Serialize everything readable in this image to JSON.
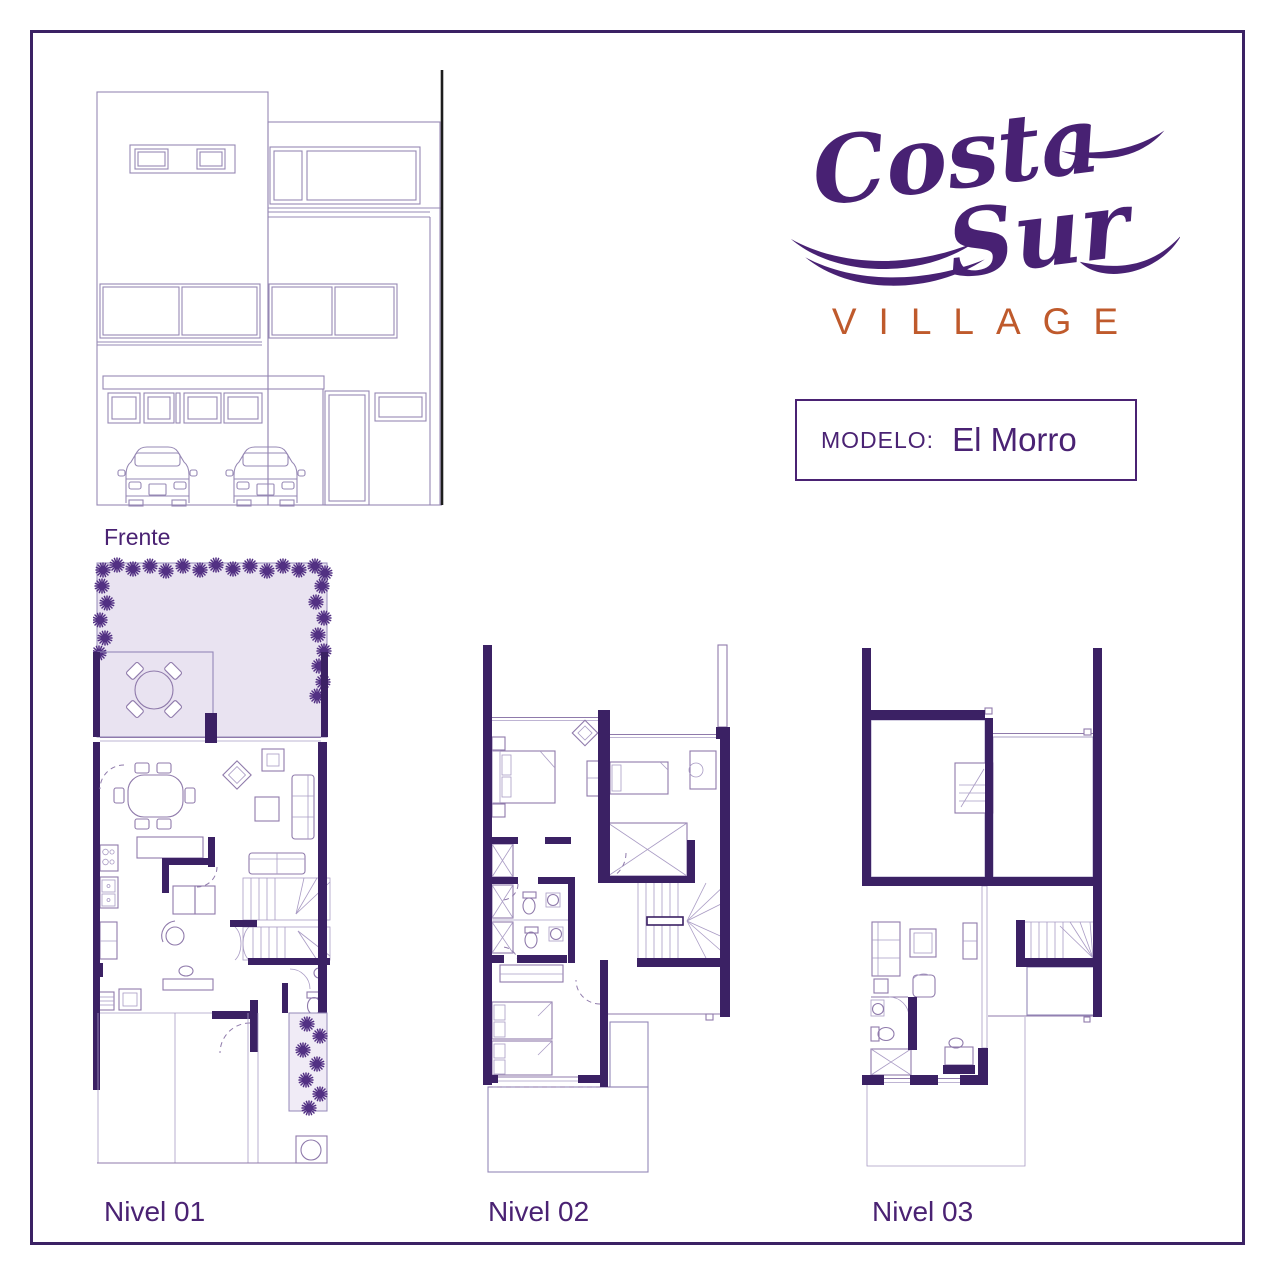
{
  "brand": {
    "name_part1": "Costa",
    "name_part2": "Sur",
    "subtitle": "VILLAGE"
  },
  "model": {
    "label": "MODELO:",
    "value": "El Morro"
  },
  "captions": {
    "elevation": "Frente",
    "level1": "Nivel 01",
    "level2": "Nivel 02",
    "level3": "Nivel 03"
  },
  "drawings": {
    "elevation": "three-story townhouse front elevation with carport, two cars, window bands and entry door",
    "level1": "ground floor plan: front garden with shrubs, wood deck with round table, living-dining room, kitchen, study, stairs, powder room, two-car garage with side planter",
    "level2": "second floor plan: master bedroom, two secondary bedrooms, two bathrooms, closets, stairs and large striped terrace",
    "level3": "third floor plan: two tiled roof terraces, family room, bathroom, desk nook, stairs and lower roof terrace"
  },
  "colors": {
    "wall": "#3b2164",
    "line": "#8f7aab",
    "line2": "#a99bc4",
    "garden": "#e9e3f1",
    "logo": "#482173",
    "accent": "#bf5a2c",
    "text": "#4a2273"
  }
}
